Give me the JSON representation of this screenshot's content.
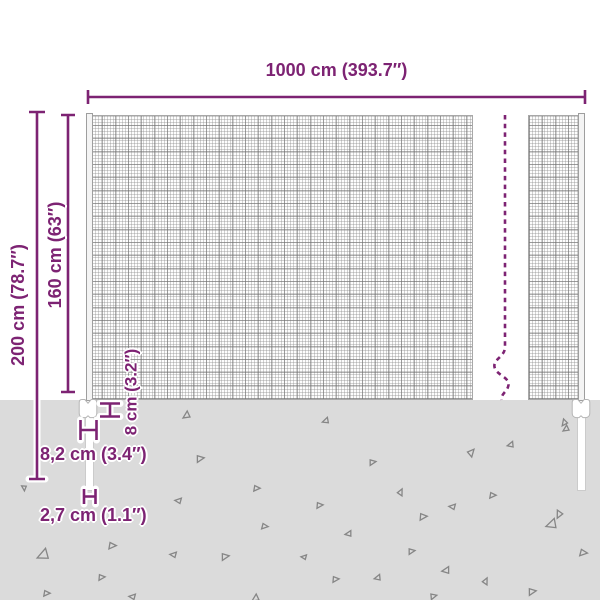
{
  "colors": {
    "accent": "#7d2373",
    "ground": "#dbdbdb",
    "mesh_line": "#9a9a9a",
    "triangle_stroke": "#868686"
  },
  "dimensions": {
    "width_label": "1000 cm (393.7″)",
    "total_height_label": "200 cm (78.7″)",
    "mesh_height_label": "160 cm (63″)",
    "clamp_height_label": "8 cm (3.2″)",
    "clamp_width_label": "8,2 cm (3.4″)",
    "pole_diameter_label": "2,7 cm (1.1″)"
  },
  "ground": {
    "triangles": [
      {
        "x": 183,
        "y": 411,
        "s": 7,
        "r": 0
      },
      {
        "x": 323,
        "y": 417,
        "s": 6,
        "r": 15
      },
      {
        "x": 561,
        "y": 419,
        "s": 6,
        "r": 340
      },
      {
        "x": 196,
        "y": 456,
        "s": 7,
        "r": 205
      },
      {
        "x": 21,
        "y": 485,
        "s": 5,
        "r": 300
      },
      {
        "x": 253,
        "y": 486,
        "s": 6,
        "r": 215
      },
      {
        "x": 176,
        "y": 497,
        "s": 6,
        "r": 40
      },
      {
        "x": 261,
        "y": 524,
        "s": 6,
        "r": 220
      },
      {
        "x": 38,
        "y": 548,
        "s": 11,
        "r": 10
      },
      {
        "x": 108,
        "y": 543,
        "s": 7,
        "r": 215
      },
      {
        "x": 171,
        "y": 551,
        "s": 6,
        "r": 40
      },
      {
        "x": 221,
        "y": 554,
        "s": 7,
        "r": 205
      },
      {
        "x": 98,
        "y": 575,
        "s": 6,
        "r": 210
      },
      {
        "x": 43,
        "y": 591,
        "s": 6,
        "r": 215
      },
      {
        "x": 130,
        "y": 593,
        "s": 6,
        "r": 40
      },
      {
        "x": 252,
        "y": 594,
        "s": 7,
        "r": 0
      },
      {
        "x": 369,
        "y": 460,
        "s": 6,
        "r": 205
      },
      {
        "x": 398,
        "y": 490,
        "s": 6,
        "r": 150
      },
      {
        "x": 468,
        "y": 450,
        "s": 7,
        "r": 165
      },
      {
        "x": 508,
        "y": 441,
        "s": 6,
        "r": 20
      },
      {
        "x": 563,
        "y": 425,
        "s": 6,
        "r": 0
      },
      {
        "x": 316,
        "y": 503,
        "s": 6,
        "r": 210
      },
      {
        "x": 346,
        "y": 530,
        "s": 6,
        "r": 25
      },
      {
        "x": 419,
        "y": 514,
        "s": 7,
        "r": 210
      },
      {
        "x": 450,
        "y": 503,
        "s": 6,
        "r": 40
      },
      {
        "x": 489,
        "y": 493,
        "s": 6,
        "r": 215
      },
      {
        "x": 555,
        "y": 510,
        "s": 7,
        "r": 330
      },
      {
        "x": 547,
        "y": 518,
        "s": 10,
        "r": 15
      },
      {
        "x": 579,
        "y": 550,
        "s": 7,
        "r": 220
      },
      {
        "x": 408,
        "y": 549,
        "s": 6,
        "r": 205
      },
      {
        "x": 443,
        "y": 566,
        "s": 7,
        "r": 25
      },
      {
        "x": 483,
        "y": 579,
        "s": 6,
        "r": 150
      },
      {
        "x": 528,
        "y": 589,
        "s": 7,
        "r": 205
      },
      {
        "x": 302,
        "y": 554,
        "s": 5,
        "r": 40
      },
      {
        "x": 332,
        "y": 577,
        "s": 6,
        "r": 210
      },
      {
        "x": 375,
        "y": 574,
        "s": 6,
        "r": 20
      },
      {
        "x": 430,
        "y": 594,
        "s": 6,
        "r": 200
      }
    ]
  }
}
